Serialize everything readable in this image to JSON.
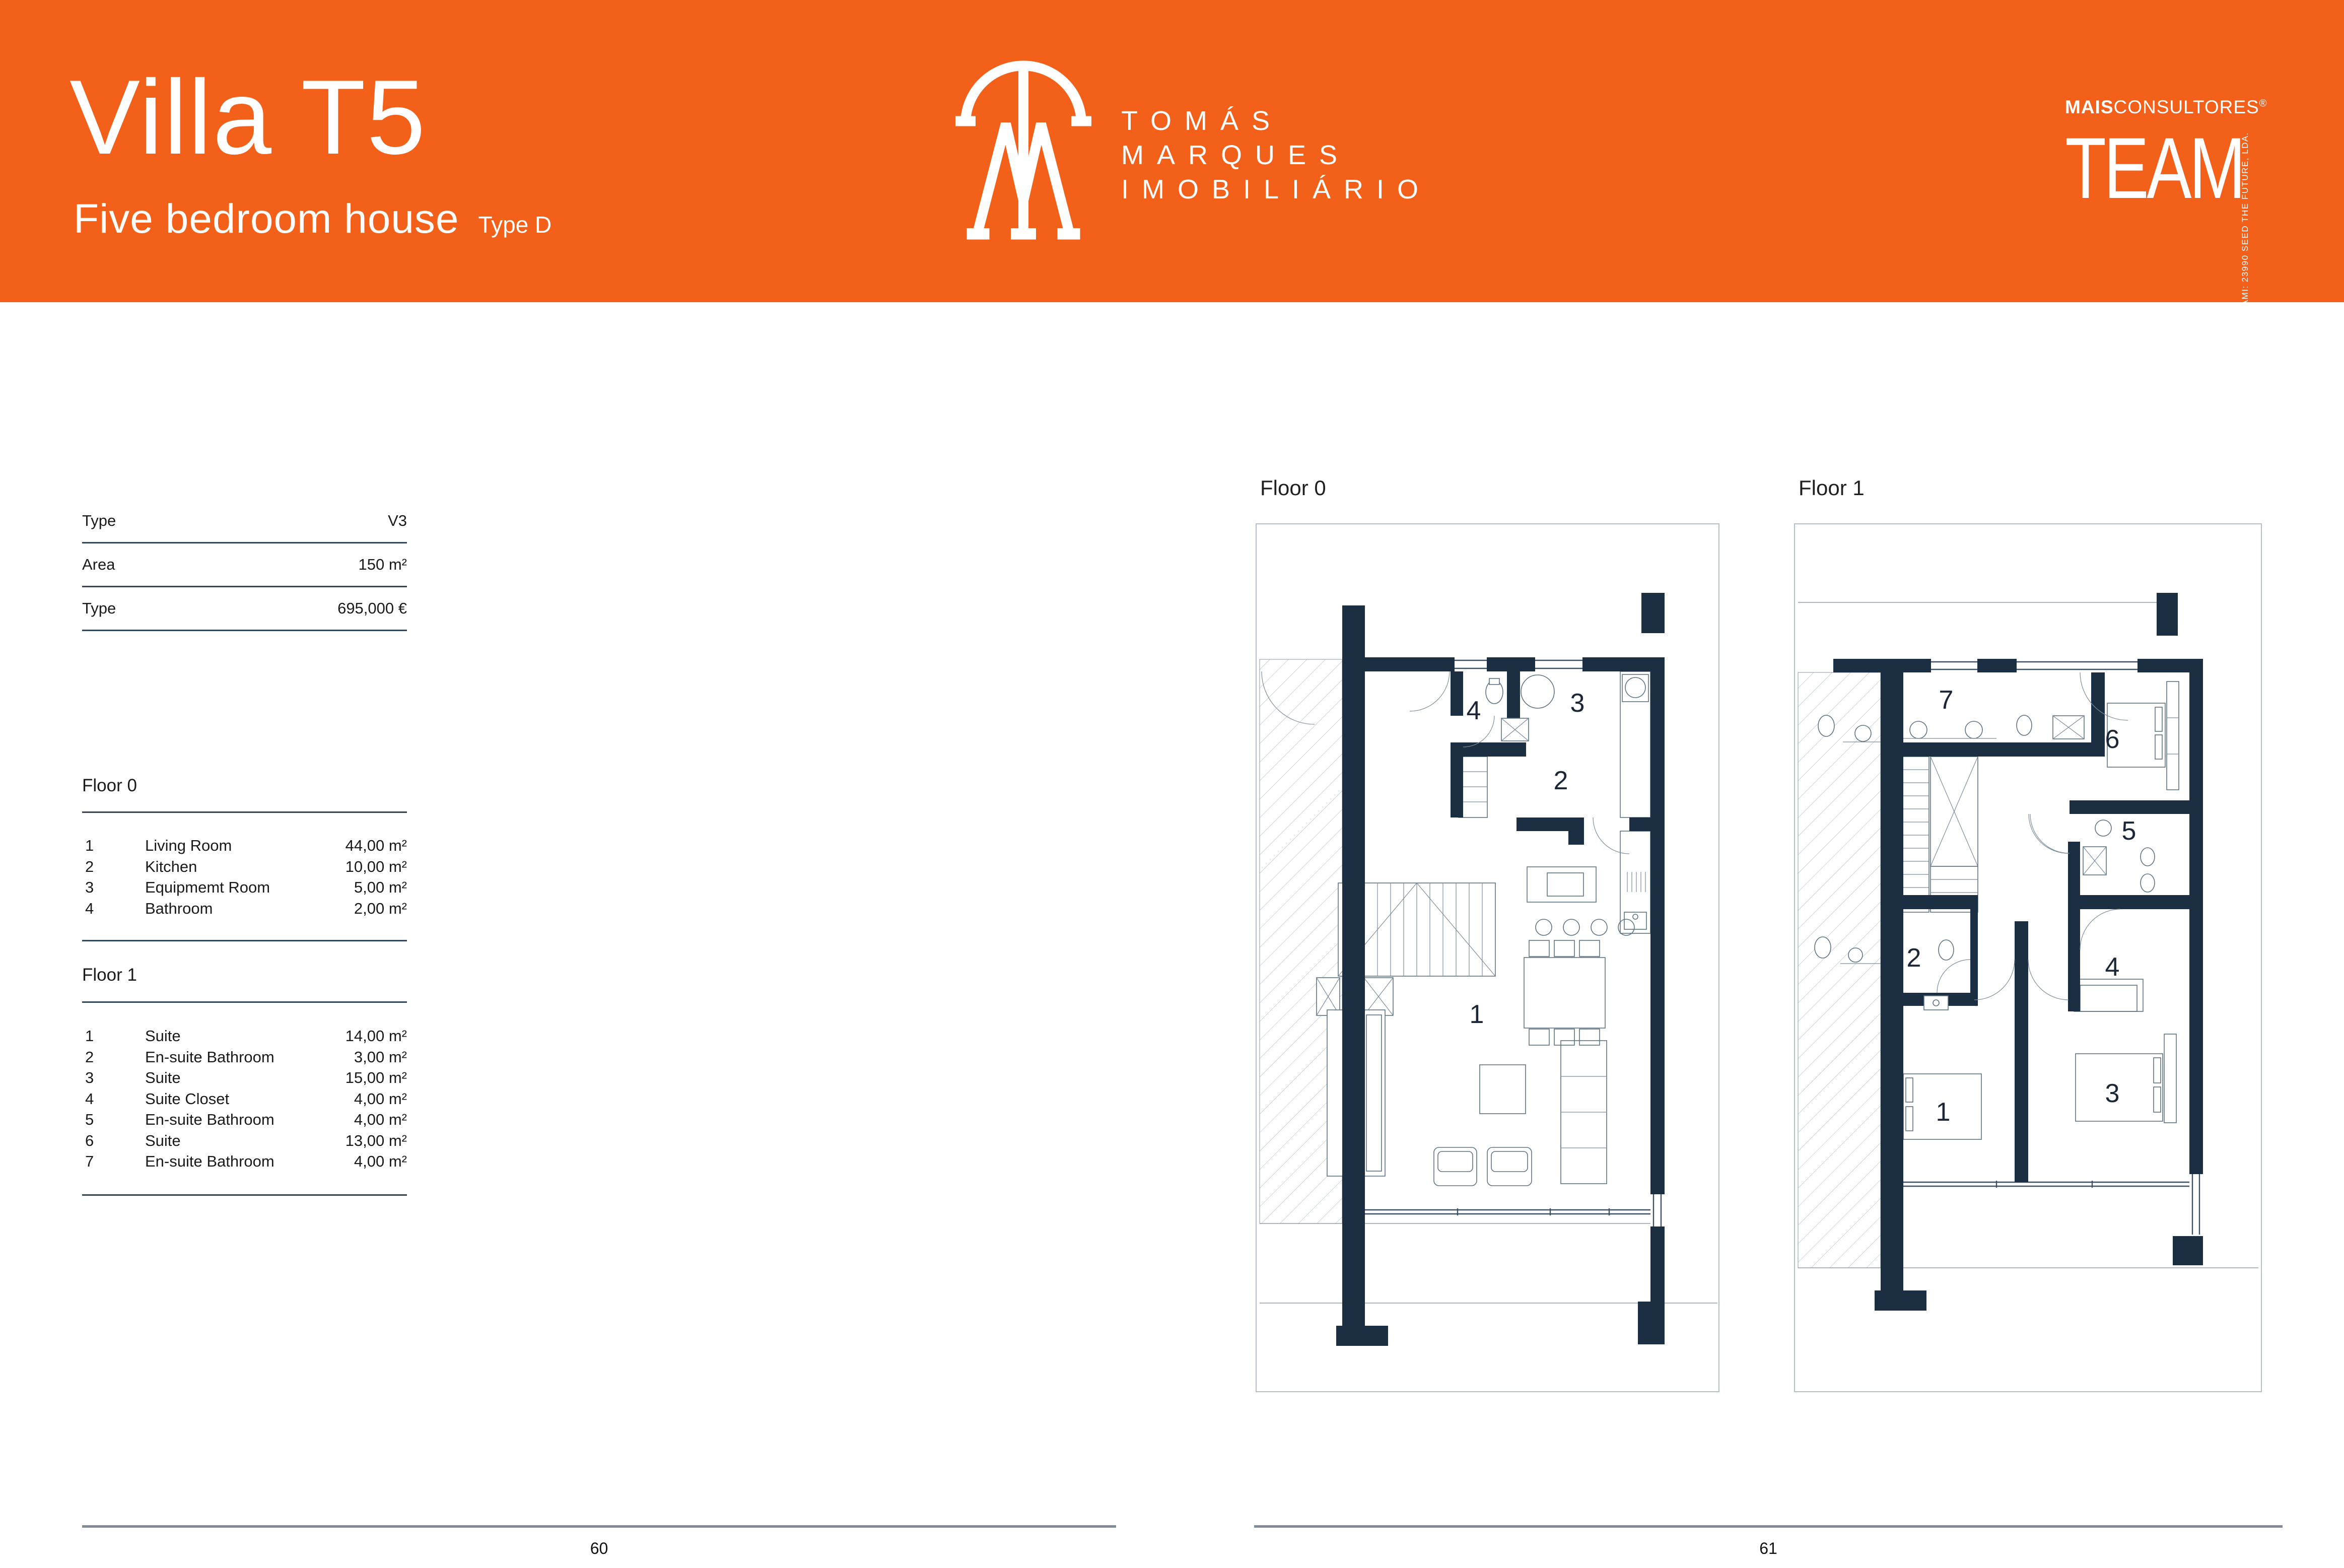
{
  "colors": {
    "header_orange": "#F2601A",
    "wall_navy": "#1C2F42",
    "rule_navy": "#33475C",
    "footer_gray": "#838B94"
  },
  "header": {
    "title": "Villa T5",
    "subtitle": "Five bedroom house",
    "type_tag": "Type D",
    "brand": {
      "name_line1": "TOMÁS",
      "name_line2": "MARQUES",
      "name_line3": "IMOBILIÁRIO"
    },
    "team_logo": {
      "prefix": "MAIS",
      "suffix": "CONSULTORES",
      "reg_mark": "®",
      "word": "TEAM",
      "side_text": "AMI: 23990   SEED THE FUTURE, LDA."
    }
  },
  "info_table": {
    "rows": [
      {
        "label": "Type",
        "value": "V3"
      },
      {
        "label": "Area",
        "value": "150 m²"
      },
      {
        "label": "Type",
        "value": "695,000 €"
      }
    ]
  },
  "floor_sections": [
    {
      "title": "Floor 0",
      "rooms": [
        {
          "num": "1",
          "name": "Living Room",
          "area": "44,00 m²"
        },
        {
          "num": "2",
          "name": "Kitchen",
          "area": "10,00 m²"
        },
        {
          "num": "3",
          "name": "Equipmemt Room",
          "area": "5,00 m²"
        },
        {
          "num": "4",
          "name": "Bathroom",
          "area": "2,00 m²"
        }
      ]
    },
    {
      "title": "Floor 1",
      "rooms": [
        {
          "num": "1",
          "name": "Suite",
          "area": "14,00 m²"
        },
        {
          "num": "2",
          "name": "En-suite Bathroom",
          "area": "3,00 m²"
        },
        {
          "num": "3",
          "name": "Suite",
          "area": "15,00 m²"
        },
        {
          "num": "4",
          "name": "Suite Closet",
          "area": "4,00 m²"
        },
        {
          "num": "5",
          "name": "En-suite Bathroom",
          "area": "4,00 m²"
        },
        {
          "num": "6",
          "name": "Suite",
          "area": "13,00 m²"
        },
        {
          "num": "7",
          "name": "En-suite Bathroom",
          "area": "4,00 m²"
        }
      ]
    }
  ],
  "plans": [
    {
      "title": "Floor 0",
      "room_numbers": [
        "1",
        "2",
        "3",
        "4"
      ]
    },
    {
      "title": "Floor 1",
      "room_numbers": [
        "1",
        "2",
        "3",
        "4",
        "5",
        "6",
        "7"
      ]
    }
  ],
  "footer": {
    "left_page": "60",
    "right_page": "61"
  }
}
